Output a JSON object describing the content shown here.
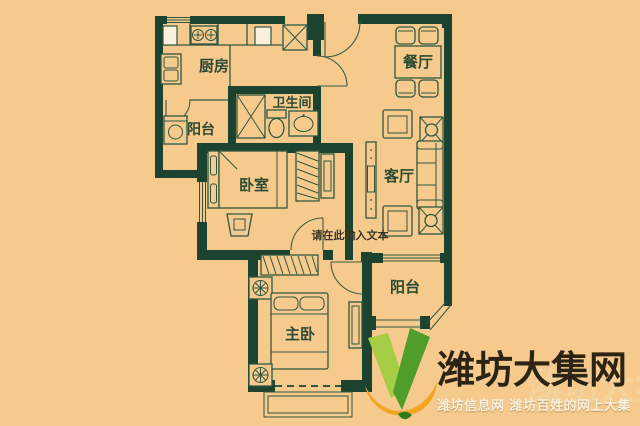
{
  "image": {
    "width": 640,
    "height": 426,
    "kind": "apartment-floor-plan"
  },
  "colors": {
    "background": "#f6ca8d",
    "wall": "#1c4330",
    "line": "#2f5740",
    "room_label_text": "#2b4a33",
    "placeholder_text": "#3b3425",
    "logo_green_light": "#a4cc45",
    "logo_green_dark": "#4f9e2c",
    "logo_orange": "#f2a31f",
    "watermark_title_text": "#2e2416",
    "watermark_subtitle_text": "#f8f1de"
  },
  "floor_plan": {
    "rooms": [
      {
        "id": "kitchen",
        "label": "厨房"
      },
      {
        "id": "dining-room",
        "label": "餐厅"
      },
      {
        "id": "balcony-left",
        "label": "阳台"
      },
      {
        "id": "bathroom",
        "label": "卫生间"
      },
      {
        "id": "bedroom",
        "label": "卧室"
      },
      {
        "id": "living-room",
        "label": "客厅"
      },
      {
        "id": "master-bedroom",
        "label": "主卧"
      },
      {
        "id": "balcony-right",
        "label": "阳台"
      }
    ],
    "placeholder_text": "请在此输入文本"
  },
  "watermark": {
    "title": "潍坊大集网",
    "subtitle": "潍坊信息网 潍坊百姓的网上大集"
  }
}
